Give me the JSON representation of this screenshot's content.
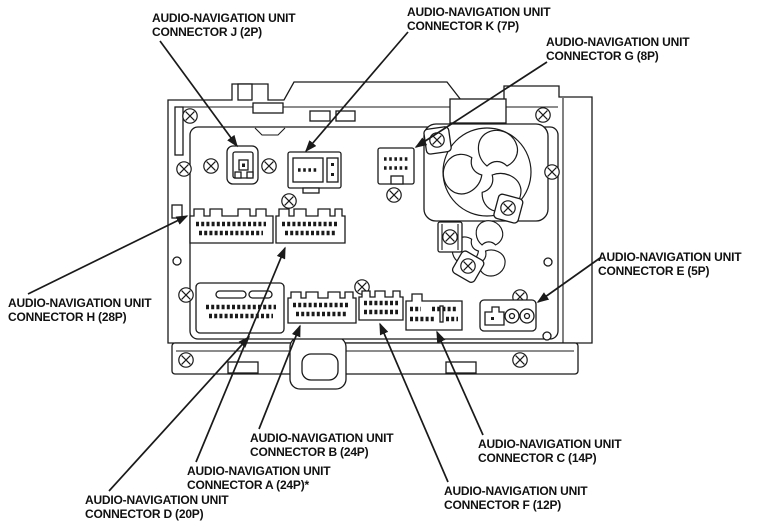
{
  "figure": {
    "ink_color": "#1a1a1a",
    "background_color": "#ffffff"
  },
  "labels": [
    {
      "id": "connector-j",
      "line1": "AUDIO-NAVIGATION UNIT",
      "line2": "CONNECTOR J (2P)",
      "x": 152,
      "y": 11,
      "leader": {
        "x1": 160,
        "y1": 41,
        "x2": 237,
        "y2": 146
      }
    },
    {
      "id": "connector-k",
      "line1": "AUDIO-NAVIGATION UNIT",
      "line2": "CONNECTOR K (7P)",
      "x": 407,
      "y": 5,
      "leader": {
        "x1": 408,
        "y1": 32,
        "x2": 306,
        "y2": 151
      }
    },
    {
      "id": "connector-g",
      "line1": "AUDIO-NAVIGATION UNIT",
      "line2": "CONNECTOR G (8P)",
      "x": 546,
      "y": 35,
      "leader": {
        "x1": 547,
        "y1": 62,
        "x2": 416,
        "y2": 147
      }
    },
    {
      "id": "connector-h",
      "line1": "AUDIO-NAVIGATION UNIT",
      "line2": "CONNECTOR H (28P)",
      "x": 8,
      "y": 296,
      "leader": {
        "x1": 28,
        "y1": 294,
        "x2": 187,
        "y2": 216
      }
    },
    {
      "id": "connector-e",
      "line1": "AUDIO-NAVIGATION UNIT",
      "line2": "CONNECTOR E (5P)",
      "x": 598,
      "y": 250,
      "leader": {
        "x1": 600,
        "y1": 258,
        "x2": 538,
        "y2": 302
      }
    },
    {
      "id": "connector-b",
      "line1": "AUDIO-NAVIGATION UNIT",
      "line2": "CONNECTOR B (24P)",
      "x": 250,
      "y": 431,
      "leader": {
        "x1": 259,
        "y1": 429,
        "x2": 300,
        "y2": 326
      }
    },
    {
      "id": "connector-a",
      "line1": "AUDIO-NAVIGATION UNIT",
      "line2": "CONNECTOR A (24P)*",
      "x": 187,
      "y": 464,
      "leader": {
        "x1": 196,
        "y1": 462,
        "x2": 285,
        "y2": 248
      }
    },
    {
      "id": "connector-d",
      "line1": "AUDIO-NAVIGATION UNIT",
      "line2": "CONNECTOR D (20P)",
      "x": 85,
      "y": 493,
      "leader": {
        "x1": 109,
        "y1": 491,
        "x2": 249,
        "y2": 337
      }
    },
    {
      "id": "connector-f",
      "line1": "AUDIO-NAVIGATION UNIT",
      "line2": "CONNECTOR F (12P)",
      "x": 444,
      "y": 484,
      "leader": {
        "x1": 448,
        "y1": 482,
        "x2": 380,
        "y2": 324
      }
    },
    {
      "id": "connector-c",
      "line1": "AUDIO-NAVIGATION UNIT",
      "line2": "CONNECTOR C (14P)",
      "x": 478,
      "y": 437,
      "leader": {
        "x1": 483,
        "y1": 435,
        "x2": 437,
        "y2": 332
      }
    }
  ]
}
